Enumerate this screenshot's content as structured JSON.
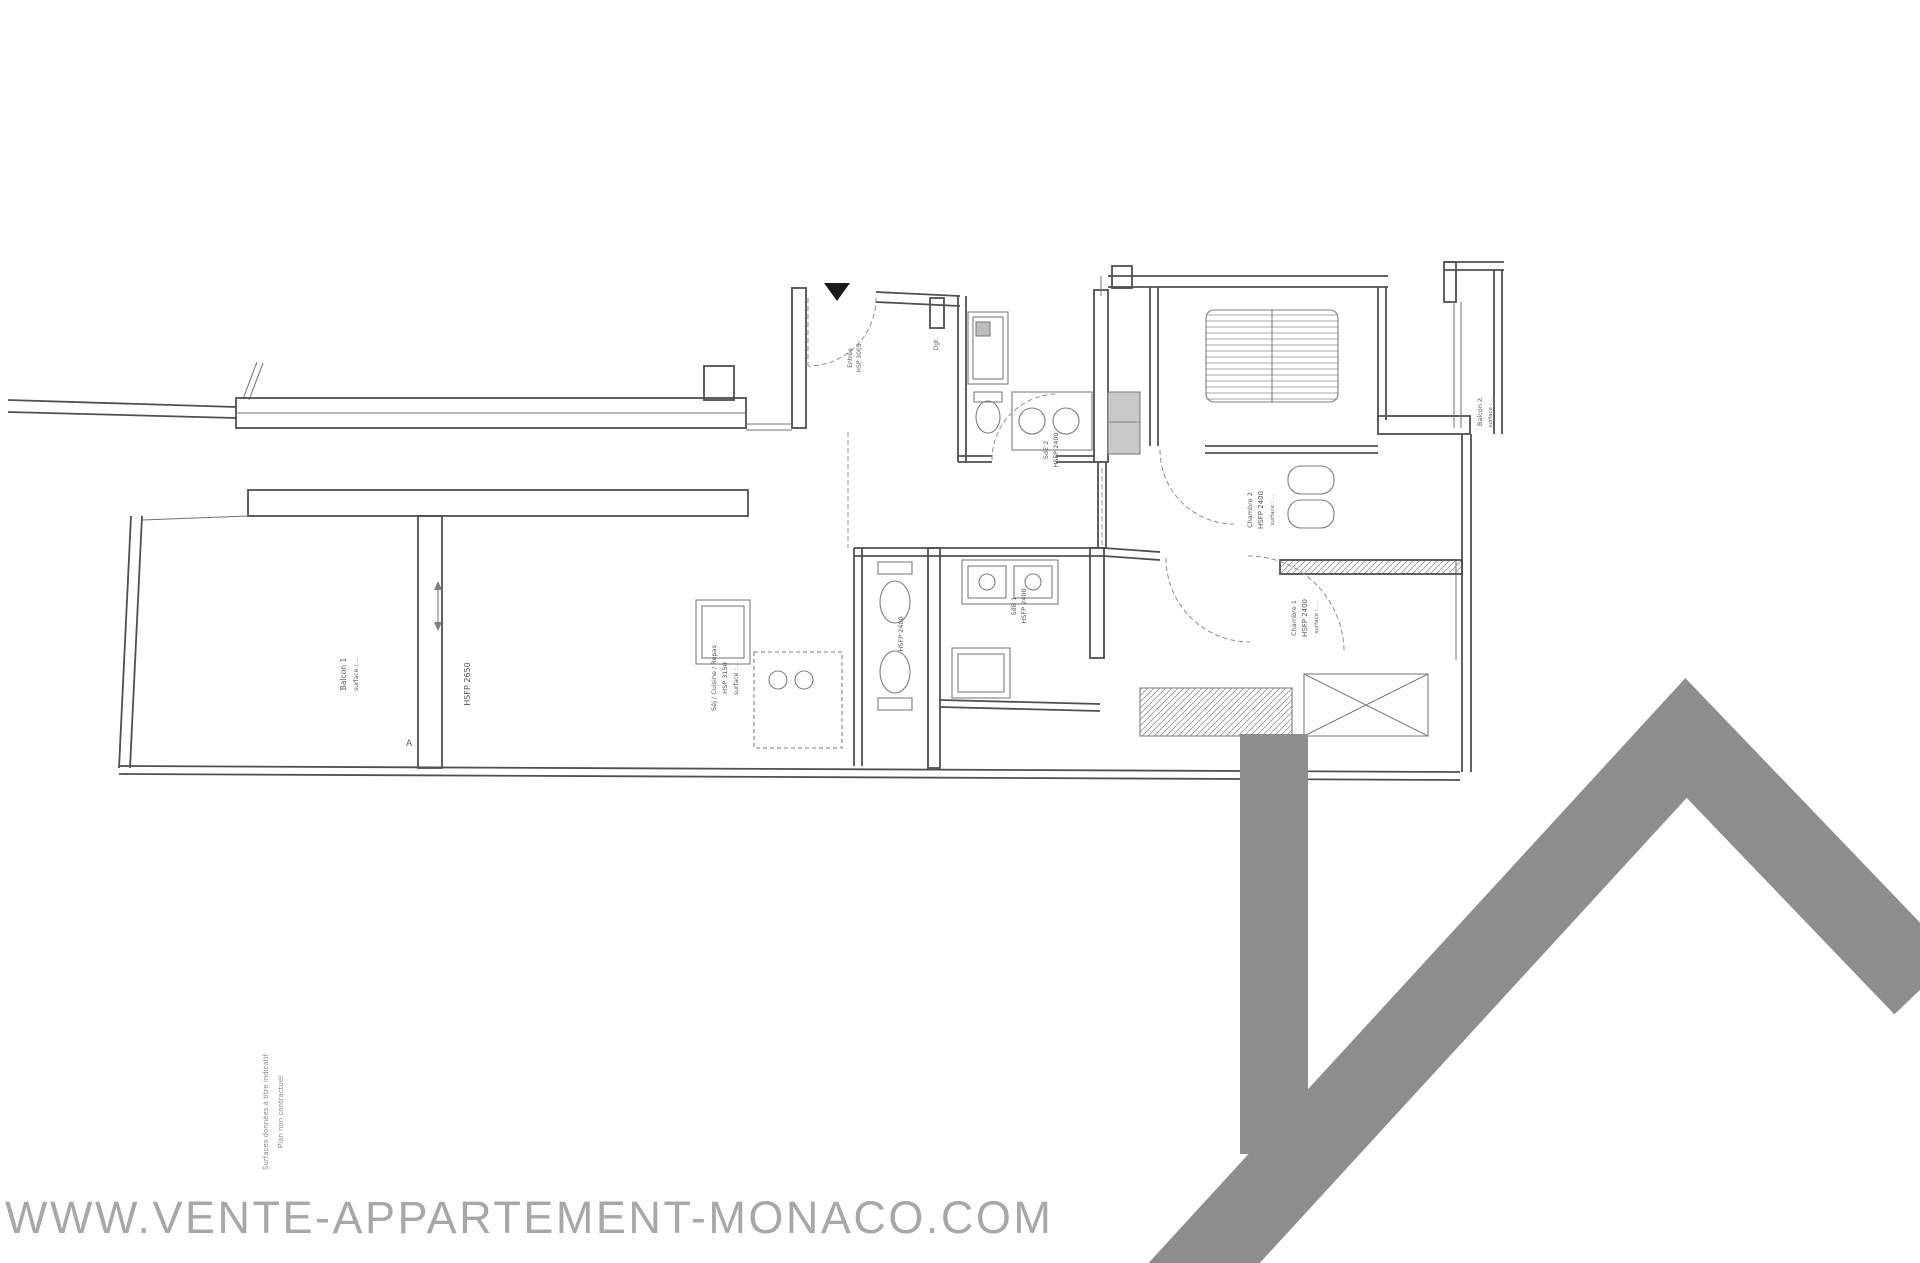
{
  "watermark": {
    "text": "WWW.VENTE-APPARTEMENT-MONACO.COM",
    "color": "#a7a7a7"
  },
  "logo": {
    "shape": "house-roof-with-chimney",
    "color": "#8d8d8d"
  },
  "plan": {
    "balcon1": {
      "title": "Balcon 1",
      "surface": "surface : ..."
    },
    "sejour": {
      "height_note": "HSFP 2650",
      "title": "Séj / Cuisine / Repas",
      "height": "HSP 3150",
      "surface": "surface : ..."
    },
    "entree": {
      "title": "Entrée",
      "height": "HSP 3005"
    },
    "degagement": {
      "title": "Dgt"
    },
    "sde2": {
      "title": "SdE 2",
      "height": "HSFP 2400"
    },
    "wc": {
      "height": "HSFP 2400"
    },
    "sdb1": {
      "title": "SdB 1",
      "height": "HSFP 2400"
    },
    "chambre2": {
      "title": "Chambre 2",
      "height": "HSFP 2400",
      "surface": "surface : ..."
    },
    "chambre1": {
      "title": "Chambre 1",
      "height": "HSFP 2400",
      "surface": "surface : ..."
    },
    "balcon2": {
      "title": "Balcon 2",
      "surface": "surface : ..."
    },
    "section_marker": "A",
    "notes": {
      "line1": "Surfaces données à titre indicatif",
      "line2": "Plan non contractuel"
    }
  }
}
